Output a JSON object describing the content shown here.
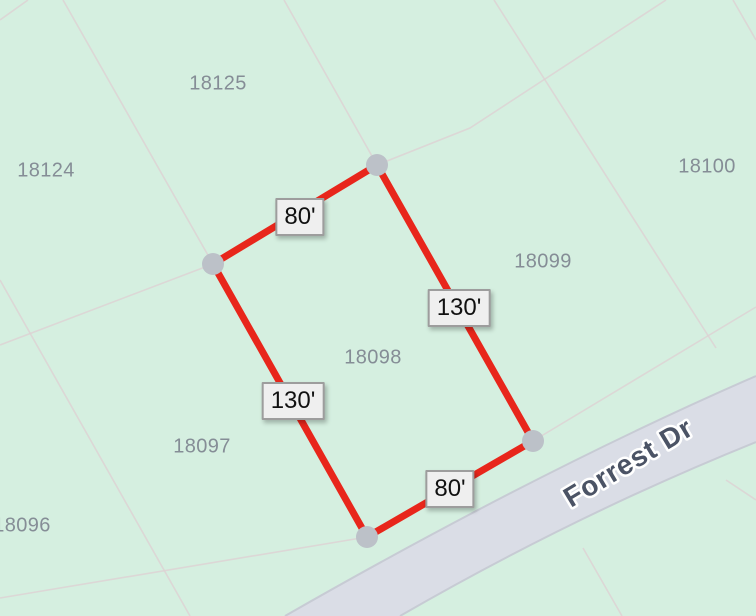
{
  "map": {
    "road_label": "Forrest Dr",
    "parcel_labels": {
      "p18124": "18124",
      "p18125": "18125",
      "p18100": "18100",
      "p18099": "18099",
      "p18098": "18098",
      "p18097": "18097",
      "p18096": "18096"
    },
    "selected_parcel": {
      "id": "18098",
      "dimension_labels": {
        "top": "80'",
        "right": "130'",
        "left": "130'",
        "bottom": "80'"
      }
    },
    "colors": {
      "map_background": "#d5efe0",
      "selected_outline": "#e8261b",
      "vertex_dot": "#bcc1c8",
      "road_fill": "#dadde6",
      "road_edge": "#c7cbd4",
      "road_label_text": "#4b5365",
      "road_label_halo": "#ffffff",
      "parcel_label_text": "#858d96",
      "parcel_line": "#ddd2d4",
      "dimension_box_bg": "#efefef",
      "dimension_box_border": "#9d9d9d",
      "dimension_text": "#111111"
    }
  }
}
